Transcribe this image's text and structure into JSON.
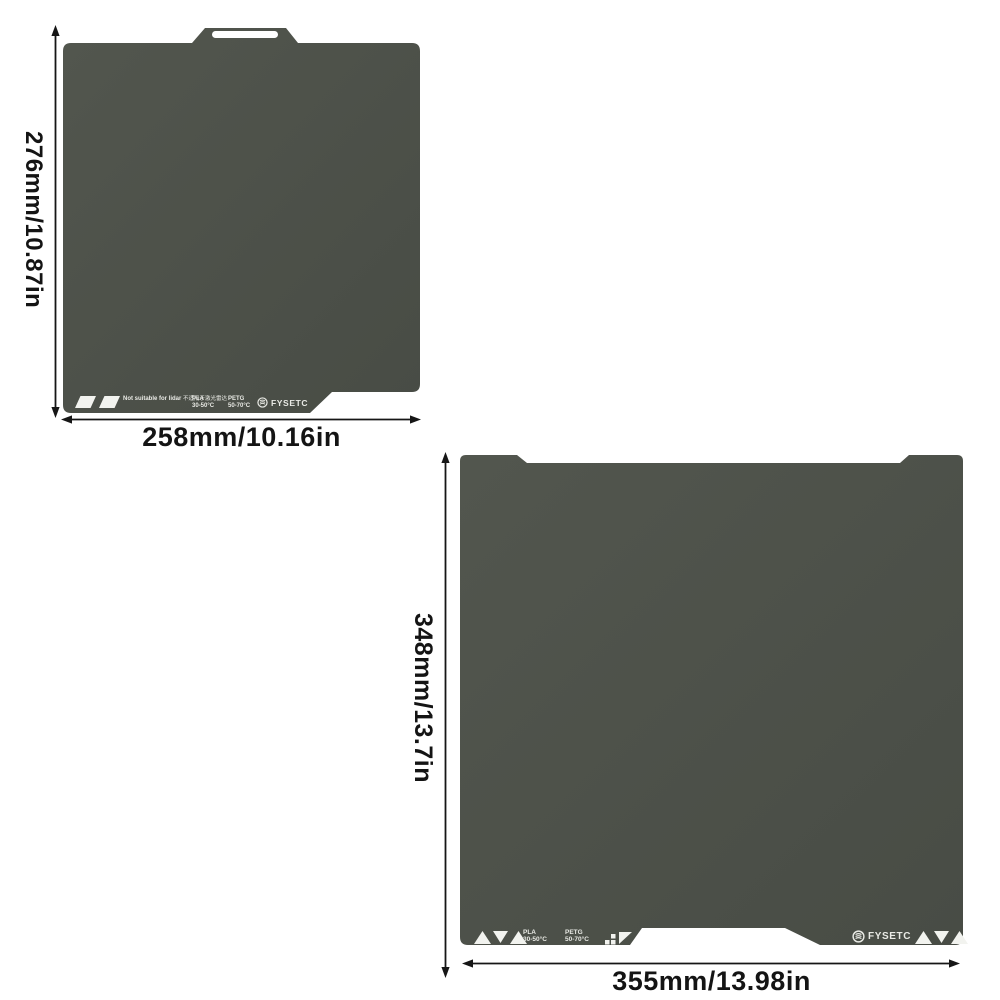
{
  "diagram": {
    "colors": {
      "plate": "#4c5049",
      "plate_light": "#545850",
      "label": "#e9eae5",
      "dimension_text": "#141414",
      "background": "#ffffff"
    },
    "plate_small": {
      "width_label": "258mm/10.16in",
      "height_label": "276mm/10.87in",
      "lidar_warning_en": "Not suitable for lidar",
      "lidar_warning_zh": "不适用于激光雷达",
      "pla_name": "PLA",
      "pla_temp": "30-50°C",
      "petg_name": "PETG",
      "petg_temp": "50-70°C",
      "brand": "FYSETC"
    },
    "plate_large": {
      "width_label": "355mm/13.98in",
      "height_label": "348mm/13.7in",
      "pla_name": "PLA",
      "pla_temp": "30-50°C",
      "petg_name": "PETG",
      "petg_temp": "50-70°C",
      "brand": "FYSETC"
    }
  }
}
